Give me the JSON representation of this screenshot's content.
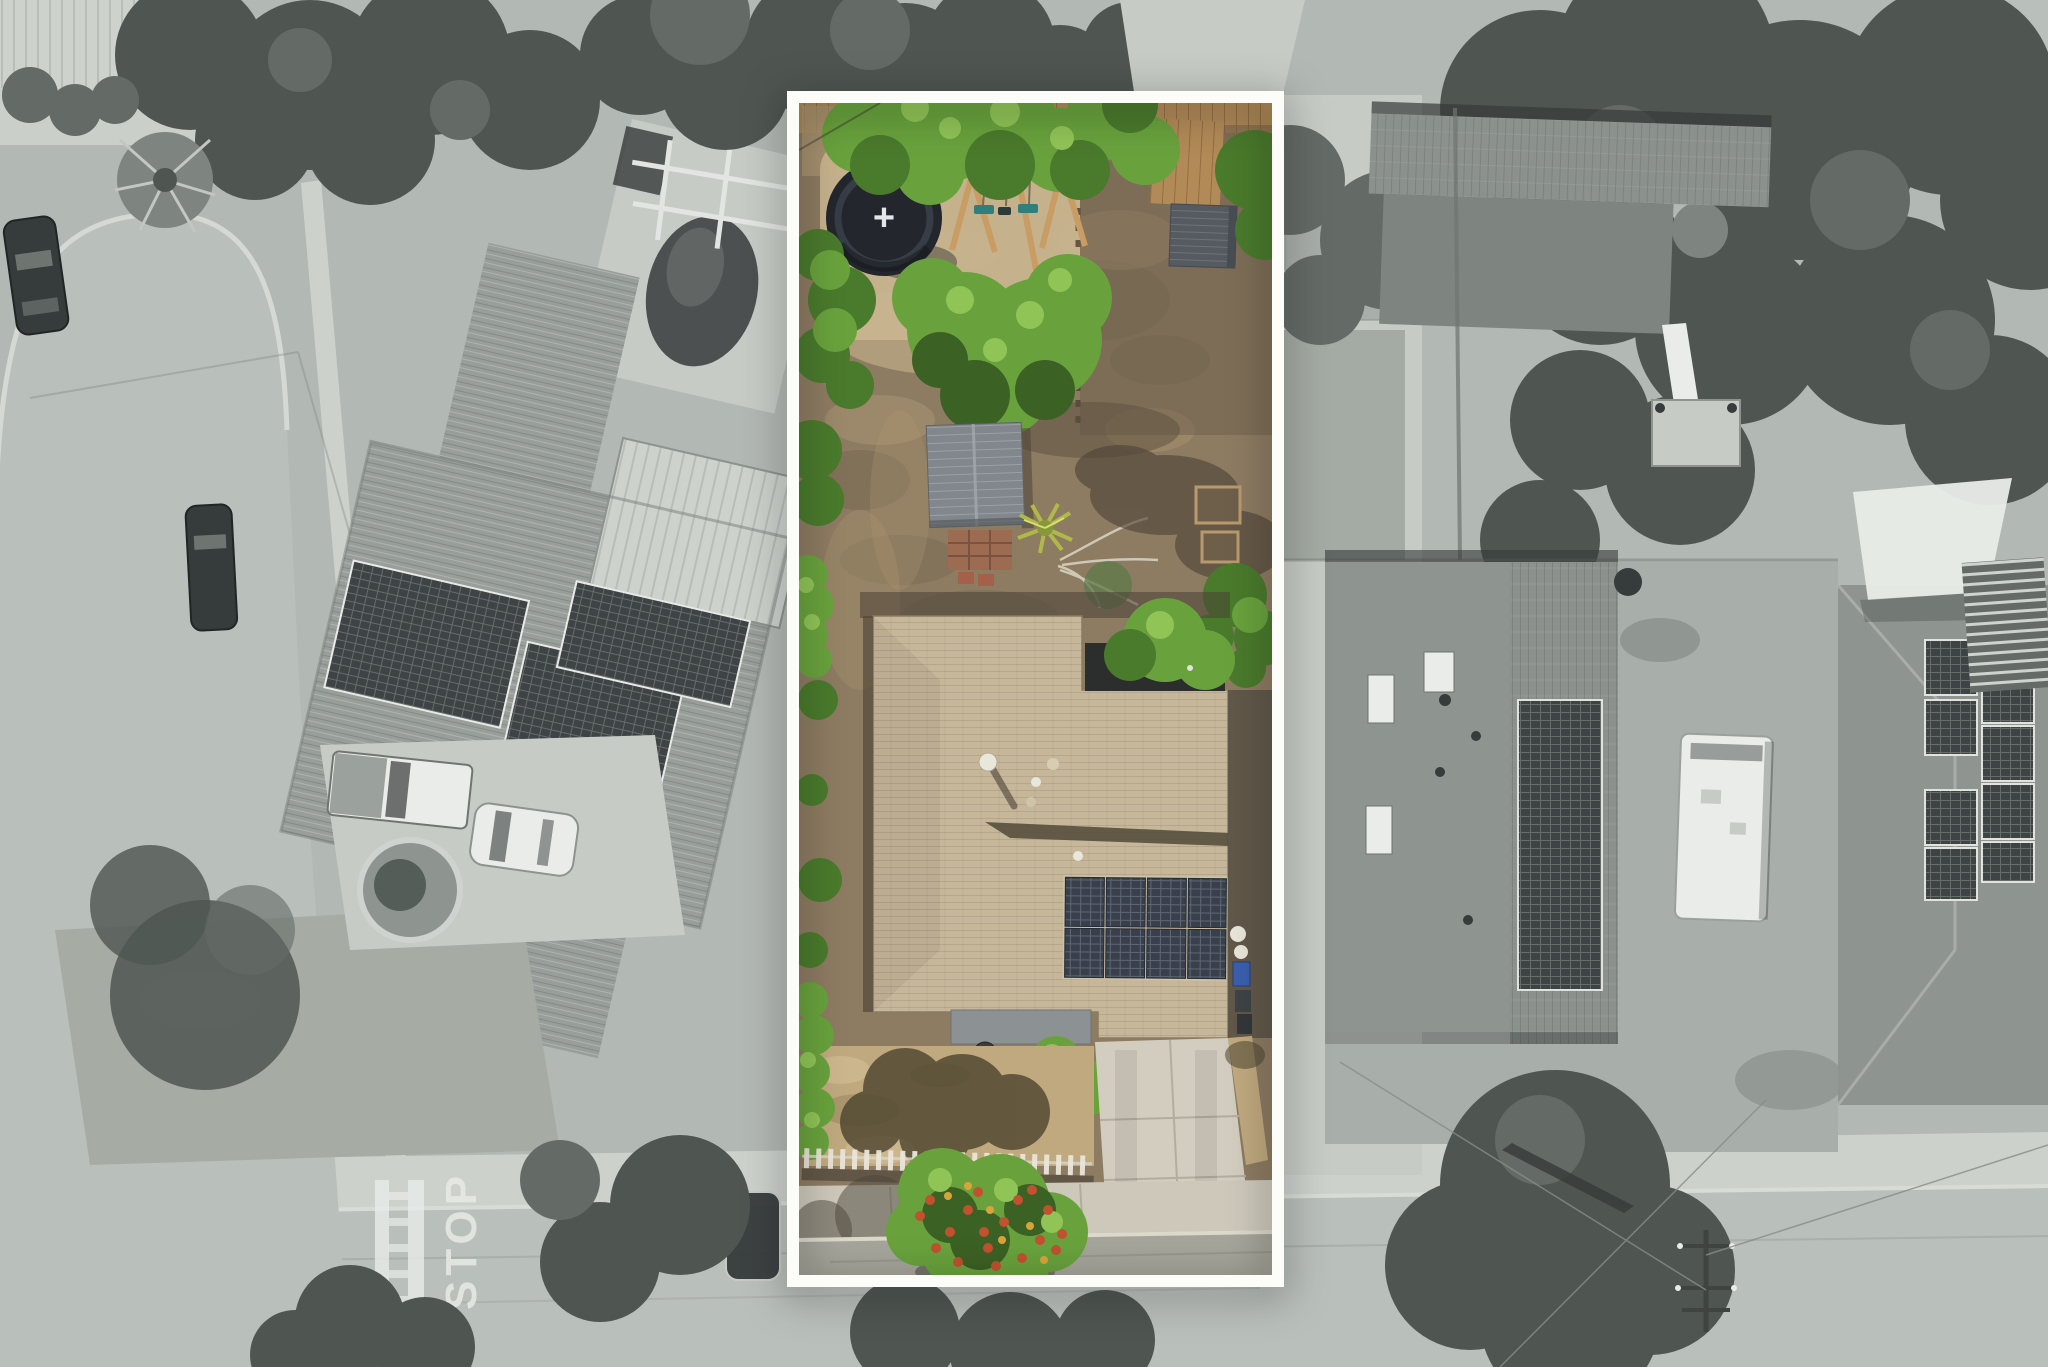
{
  "markings": {
    "stop_text": "STOP",
    "trampoline_mark": "+"
  },
  "highlight_box": {
    "border_color": "#fcfcf9"
  },
  "palette": {
    "g_base": "#b2b8b4",
    "g_road": "#b9bfba",
    "g_side": "#cdd1cc",
    "g_conc": "#c6cbc6",
    "g_dark": "#363b3b",
    "g_white": "#e9ece8",
    "g_tree1": "#4f5652",
    "g_tree2": "#646b66",
    "g_tree3": "#7e847f",
    "g_dirt": "#a8aea9",
    "g_rooftile": "#989e9a",
    "g_roofmed": "#8e948f",
    "g_rooflight": "#cdd2cd",
    "g_pv": "#3e4446",
    "c_dirt": "#8d7b62",
    "c_dirtdark": "#6e5f4b",
    "c_dirtlight": "#ab9671",
    "c_sand": "#c8b48e",
    "c_green": "#69a23d",
    "c_greendark": "#4a7a2c",
    "c_greenlight": "#90c457",
    "c_greendeep": "#3c6124",
    "c_rooftan": "#c7b79a",
    "c_roofshad": "#57503d",
    "c_porch": "#8c9193",
    "c_shed": "#555b60",
    "c_shedmid": "#81878c",
    "c_pv": "#39404b",
    "c_pvline": "#5e6775",
    "c_wood": "#b28a58",
    "c_woodlight": "#c89c62",
    "c_teal": "#2f807d",
    "c_tramp": "#23262c",
    "c_brick": "#9d6a52",
    "c_yucca": "#aeb94a",
    "c_drive": "#d3cdc0",
    "c_grassdry": "#c0a97f",
    "c_street": "#a5a59b",
    "c_blossom": "#c1512f",
    "c_gold": "#d9a33c",
    "c_white": "#f3f0e7",
    "border_white": "#fcfcf9",
    "c_binblue": "#3a5fae"
  },
  "features": {
    "highlighted_lot": [
      "wood fence along rear",
      "dark trampoline with white + mark",
      "A-frame swing set with 2 teal seats",
      "dark corrugated storage shed",
      "dirt backyard",
      "large bright green tree",
      "gray garden shed",
      "brick path and red pavers",
      "yucca plant",
      "dead branches",
      "planter boxes",
      "main house tan shingle roof",
      "rooftop solar array 4 columns x 2 rows",
      "trash bins (1 blue, 2 dark)",
      "gray porch roof",
      "paver patio with round table",
      "dry front lawn with tree shadow",
      "green hedge",
      "white picket fence",
      "flowering tree with red and gold blossoms",
      "concrete driveway",
      "sidewalk",
      "street"
    ],
    "surroundings": [
      "curved cul-de-sac street with 2 parked cars",
      "neighbor house tile roof with 3 solar arrays",
      "light metal roof",
      "covered pool and pergola",
      "palm tree",
      "pickup truck and white sedan in driveway",
      "round planter ring",
      "crosswalk with STOP pavement marking",
      "dark parked car by curb",
      "neighbor house with 3 skylights and 2x6 solar array",
      "white RV",
      "satellite dish",
      "far house with white shade sail, lattice pergola and staggered solar panels",
      "backyard playset with white slide",
      "utility pole with crossarms and power lines",
      "street trees"
    ]
  }
}
